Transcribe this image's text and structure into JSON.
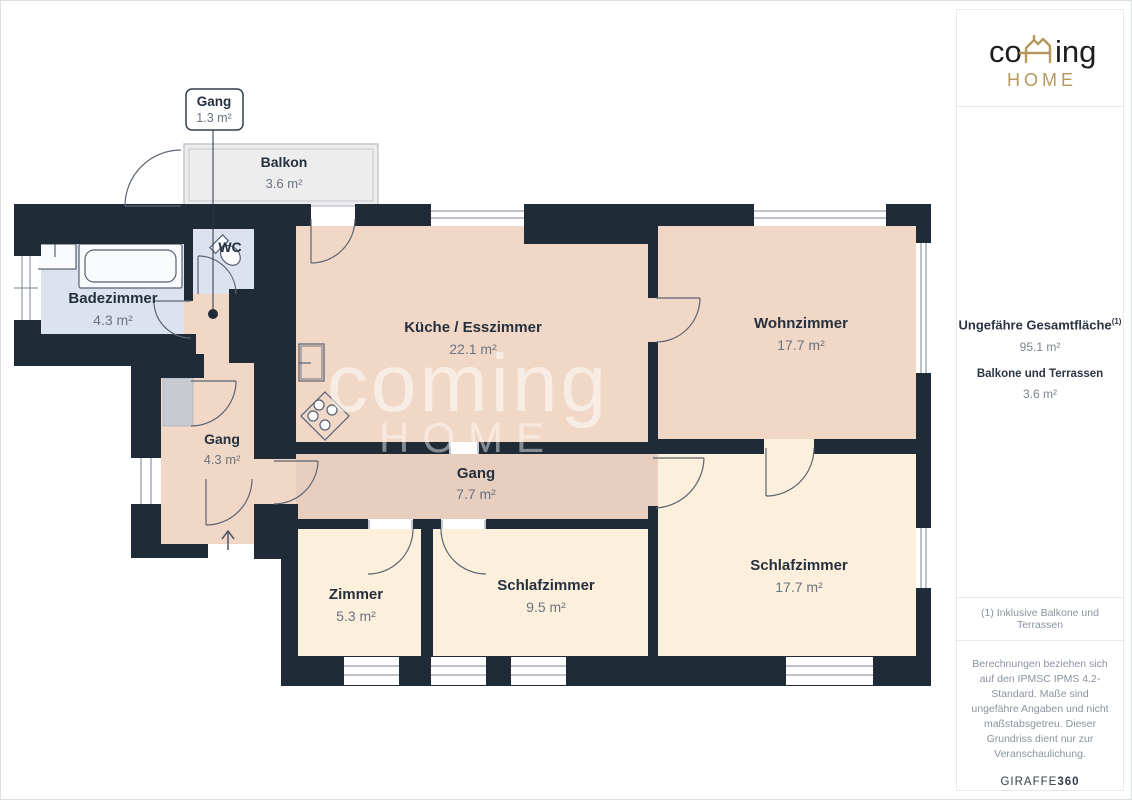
{
  "sidebar": {
    "logo": {
      "co": "co",
      "ing": "ing",
      "home": "HOME"
    },
    "total_area_label": "Ungefähre Gesamtfläche",
    "total_area_footnote_marker": "(1)",
    "total_area_value": "95.1 m²",
    "balconies_label": "Balkone und Terrassen",
    "balconies_value": "3.6 m²",
    "footnote": "(1) Inklusive Balkone und Terrassen",
    "disclaimer": "Berechnungen beziehen sich auf den IPMSC IPMS 4.2-Standard. Maße sind ungefähre Angaben und nicht maßstabsgetreu. Dieser Grundriss dient nur zur Veranschaulichung.",
    "brand": "GIRAFFE",
    "brand_bold": "360"
  },
  "watermark": {
    "line1": "coming",
    "line2": "HOME"
  },
  "rooms": {
    "gang_callout": {
      "name": "Gang",
      "area": "1.3 m²"
    },
    "balkon": {
      "name": "Balkon",
      "area": "3.6 m²"
    },
    "wc": {
      "name": "WC"
    },
    "badezimmer": {
      "name": "Badezimmer",
      "area": "4.3 m²"
    },
    "kueche": {
      "name": "Küche / Esszimmer",
      "area": "22.1 m²"
    },
    "wohnzimmer": {
      "name": "Wohnzimmer",
      "area": "17.7 m²"
    },
    "gang43": {
      "name": "Gang",
      "area": "4.3 m²"
    },
    "gang77": {
      "name": "Gang",
      "area": "7.7 m²"
    },
    "zimmer": {
      "name": "Zimmer",
      "area": "5.3 m²"
    },
    "schlafzimmer95": {
      "name": "Schlafzimmer",
      "area": "9.5 m²"
    },
    "schlafzimmer177": {
      "name": "Schlafzimmer",
      "area": "17.7 m²"
    }
  },
  "colors": {
    "wall": "#202b38",
    "room_warm": "#f0d7c6",
    "room_corridor": "#e8cebe",
    "room_cream": "#fcefdb",
    "room_wet": "#dde3ee",
    "balcony": "#ededed",
    "accent_gold": "#b6985a",
    "label_navy": "#25303f",
    "label_gray": "#6b7482"
  }
}
